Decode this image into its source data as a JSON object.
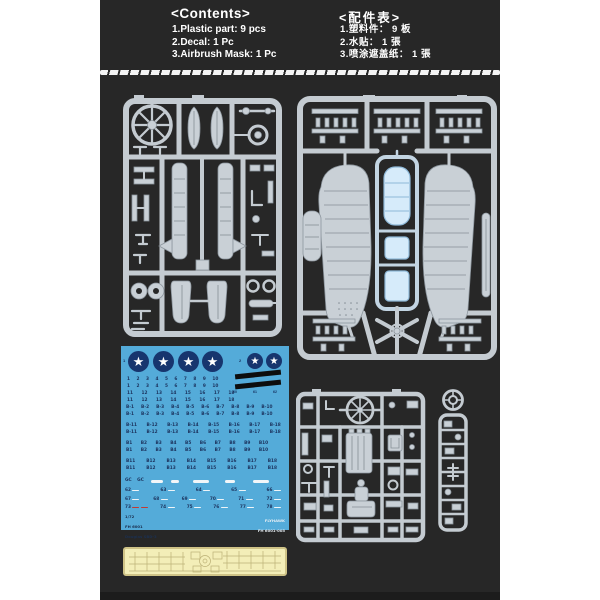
{
  "colors": {
    "panel_bg": "#272727",
    "sprue_plastic": "#c9d0d6",
    "clear_part": "#d6ebfa",
    "decal_bg": "#54abd9",
    "insignia_blue": "#17356e",
    "decal_ink": "#1d3560",
    "mask_bg": "#f3eeb8",
    "mask_border": "#cfc387"
  },
  "header": {
    "contents": {
      "title": "<Contents>",
      "items": [
        "1.Plastic part: 9 pcs",
        "2.Decal: 1 Pc",
        "3.Airbrush Mask: 1 Pc"
      ]
    },
    "parts_table": {
      "title": "<配件表>",
      "items": [
        "1.塑料件： 9 板",
        "2.水贴： 1 張",
        "3.喷涂遮盖纸： 1 張"
      ]
    }
  },
  "decal_sheet": {
    "star_glyph": "★",
    "group_labels": {
      "large": "1",
      "small": "2"
    },
    "rows": {
      "numbers_1_10": "1 2 3 4 5 6 7 8 9 10",
      "numbers_11_18": "11 12 13 14 15 16 17 18",
      "b_dash_1_10": "B-1 B-2 B-3 B-4 B-5 B-6 B-7 B-8 B-9 B-10",
      "b_dash_11_18": "B-11 B-12 B-13 B-14 B-15 B-16 B-17 B-18",
      "b_1_10": "B1 B2 B3 B4 B5 B6 B7 B8 B9 B10",
      "b_11_18": "B11 B12 B13 B14 B15 B16 B17 B18",
      "gc": "GC GC"
    },
    "stripe_labels": [
      "60",
      "61",
      "62"
    ],
    "dash_rows": {
      "r1": [
        "62",
        "63",
        "64",
        "65",
        "66"
      ],
      "r2": [
        "67",
        "68",
        "69",
        "70",
        "71",
        "72"
      ],
      "r3": [
        "73",
        "74",
        "75",
        "76",
        "77",
        "78"
      ]
    },
    "footer_left": {
      "scale": "1/72",
      "code": "FH 6001",
      "subject": "Douglas SBD-3"
    },
    "footer_right": {
      "brand": "FLYHAWK",
      "code": "FH 6001-005"
    }
  }
}
